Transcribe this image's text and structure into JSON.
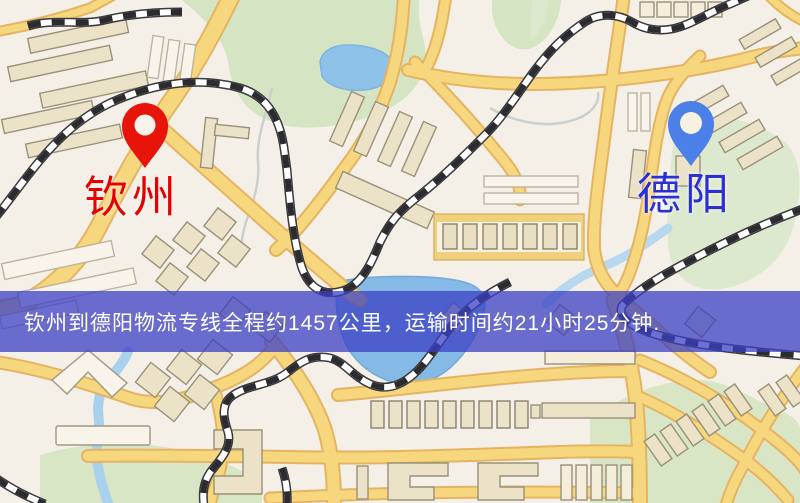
{
  "map": {
    "origin": {
      "label": "钦州",
      "pin_icon": "map-pin-icon",
      "pin_color": "#e81309",
      "label_color": "#e60000"
    },
    "destination": {
      "label": "德阳",
      "pin_icon": "map-pin-icon",
      "pin_color": "#4b80e8",
      "label_color": "#2b2fd6"
    }
  },
  "banner": {
    "text": "钦州到德阳物流专线全程约1457公里，运输时间约21小时25分钟.",
    "background_color": "rgba(58,62,196,0.74)",
    "text_color": "#ffffff"
  },
  "route": {
    "origin": "钦州",
    "destination": "德阳",
    "distance_km": 1457,
    "duration_hours": 21,
    "duration_minutes": 25
  }
}
